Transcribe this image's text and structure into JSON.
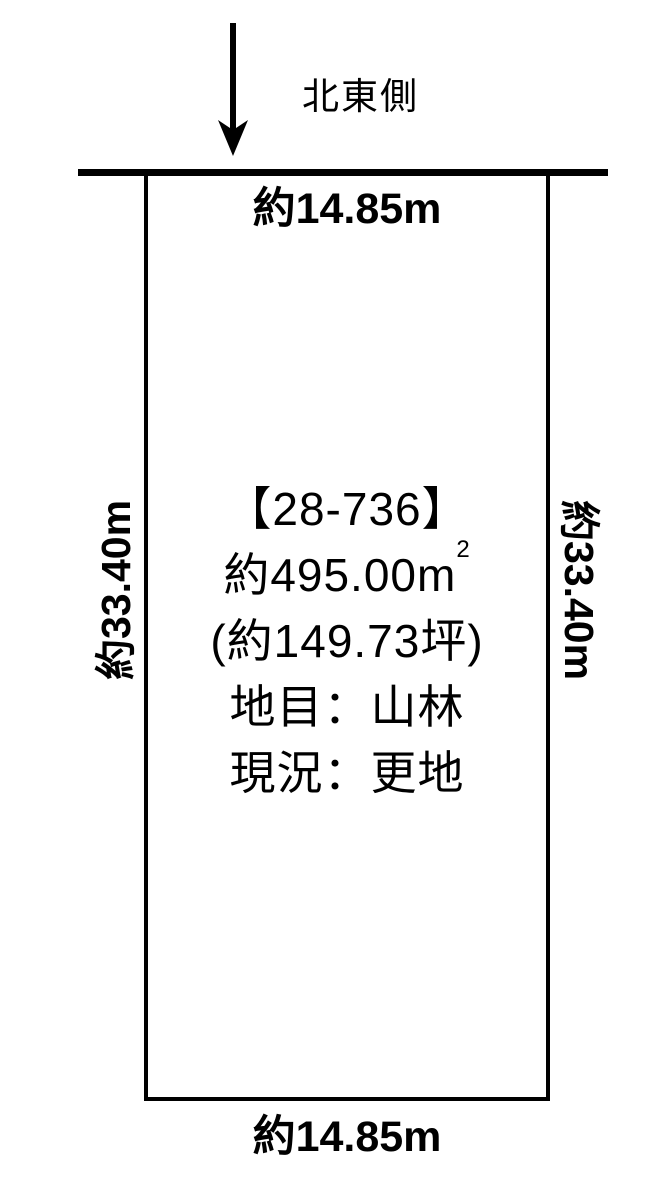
{
  "diagram": {
    "direction_label": "北東側",
    "plot": {
      "parcel_number": "【28-736】",
      "area_m2_value": "約495.00m",
      "area_m2_sup": "2",
      "area_tsubo": "(約149.73坪)",
      "land_category": "地目：山林",
      "current_condition": "現況：更地"
    },
    "dimensions": {
      "top": "約14.85m",
      "bottom": "約14.85m",
      "left": "約33.40m",
      "right": "約33.40m"
    },
    "colors": {
      "line": "#000000",
      "background": "#ffffff",
      "text": "#000000"
    }
  }
}
